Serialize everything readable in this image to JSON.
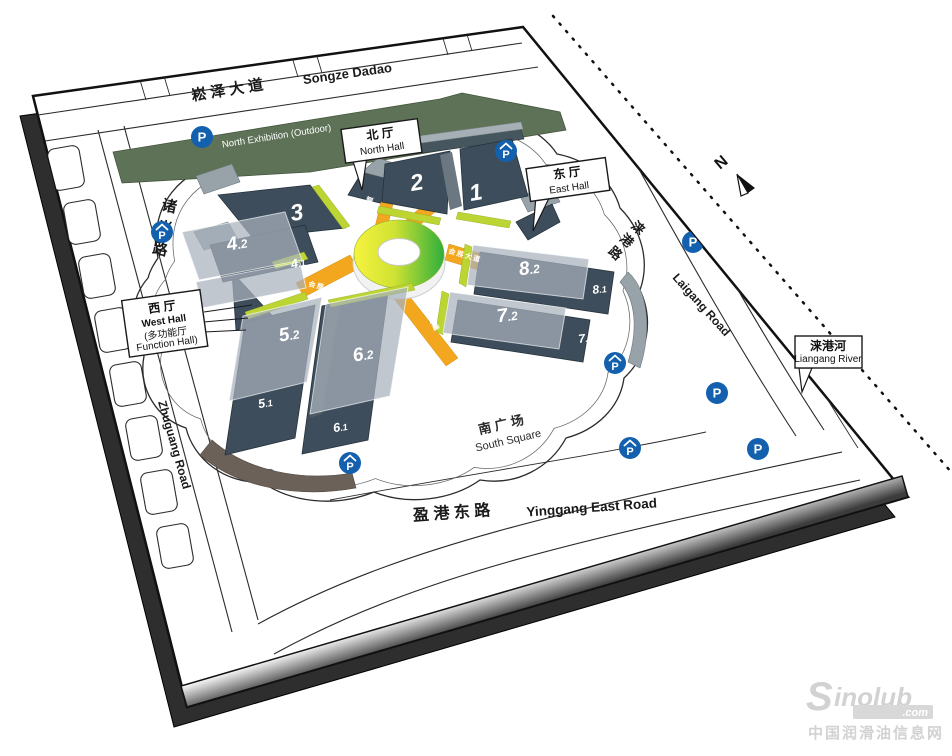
{
  "map": {
    "roads": {
      "songze_zh": "崧 泽 大 道",
      "songze_en": "Songze Dadao",
      "zhuguang_zh": "诸光路",
      "zhuguang_en": "Zhuguang Road",
      "laigang_zh": "涞港路",
      "laigang_en": "Laigang Road",
      "yinggang_zh": "盈 港 东 路",
      "yinggang_en": "Yinggang East Road",
      "avenue_zh": "会展大道"
    },
    "areas": {
      "north_exhibition_zh": "北展场 (室外)",
      "north_exhibition_en": "North Exhibition (Outdoor)",
      "south_square_zh": "南 广 场",
      "south_square_en": "South Square"
    },
    "callouts": {
      "north_hall_zh": "北 厅",
      "north_hall_en": "North Hall",
      "east_hall_zh": "东 厅",
      "east_hall_en": "East Hall",
      "west_hall_zh": "西 厅",
      "west_hall_en": "West Hall",
      "west_hall_sub_zh": "(多功能厅",
      "west_hall_sub_en": "Function Hall)",
      "river_zh": "涞港河",
      "river_en": "Liangang River"
    },
    "halls": {
      "h1": {
        "main": "1",
        "sub": ""
      },
      "h2": {
        "main": "2",
        "sub": ""
      },
      "h3": {
        "main": "3",
        "sub": ""
      },
      "h41": {
        "main": "4",
        "sub": ".1"
      },
      "h42": {
        "main": "4",
        "sub": ".2"
      },
      "h51": {
        "main": "5",
        "sub": ".1"
      },
      "h52": {
        "main": "5",
        "sub": ".2"
      },
      "h61": {
        "main": "6",
        "sub": ".1"
      },
      "h62": {
        "main": "6",
        "sub": ".2"
      },
      "h71": {
        "main": "7",
        "sub": ".1"
      },
      "h72": {
        "main": "7",
        "sub": ".2"
      },
      "h81": {
        "main": "8",
        "sub": ".1"
      },
      "h82": {
        "main": "8",
        "sub": ".2"
      }
    },
    "compass_label": "N",
    "parking_label": "P"
  },
  "watermark": {
    "brand_initial": "S",
    "brand_rest": "inolub",
    "tld": ".com",
    "tagline_zh": "中国润滑油信息网"
  },
  "colors": {
    "hall_dark": "#3d4d5b",
    "overlay_gray": "rgba(168,178,188,0.72)",
    "north_exhibition_green": "#5d7257",
    "lime_strip": "#bcd532",
    "avenue_orange": "#f2a71f",
    "parking_blue": "#1361ae",
    "ring_yellow": "#f7f33e",
    "ring_green": "#2fae3c"
  }
}
